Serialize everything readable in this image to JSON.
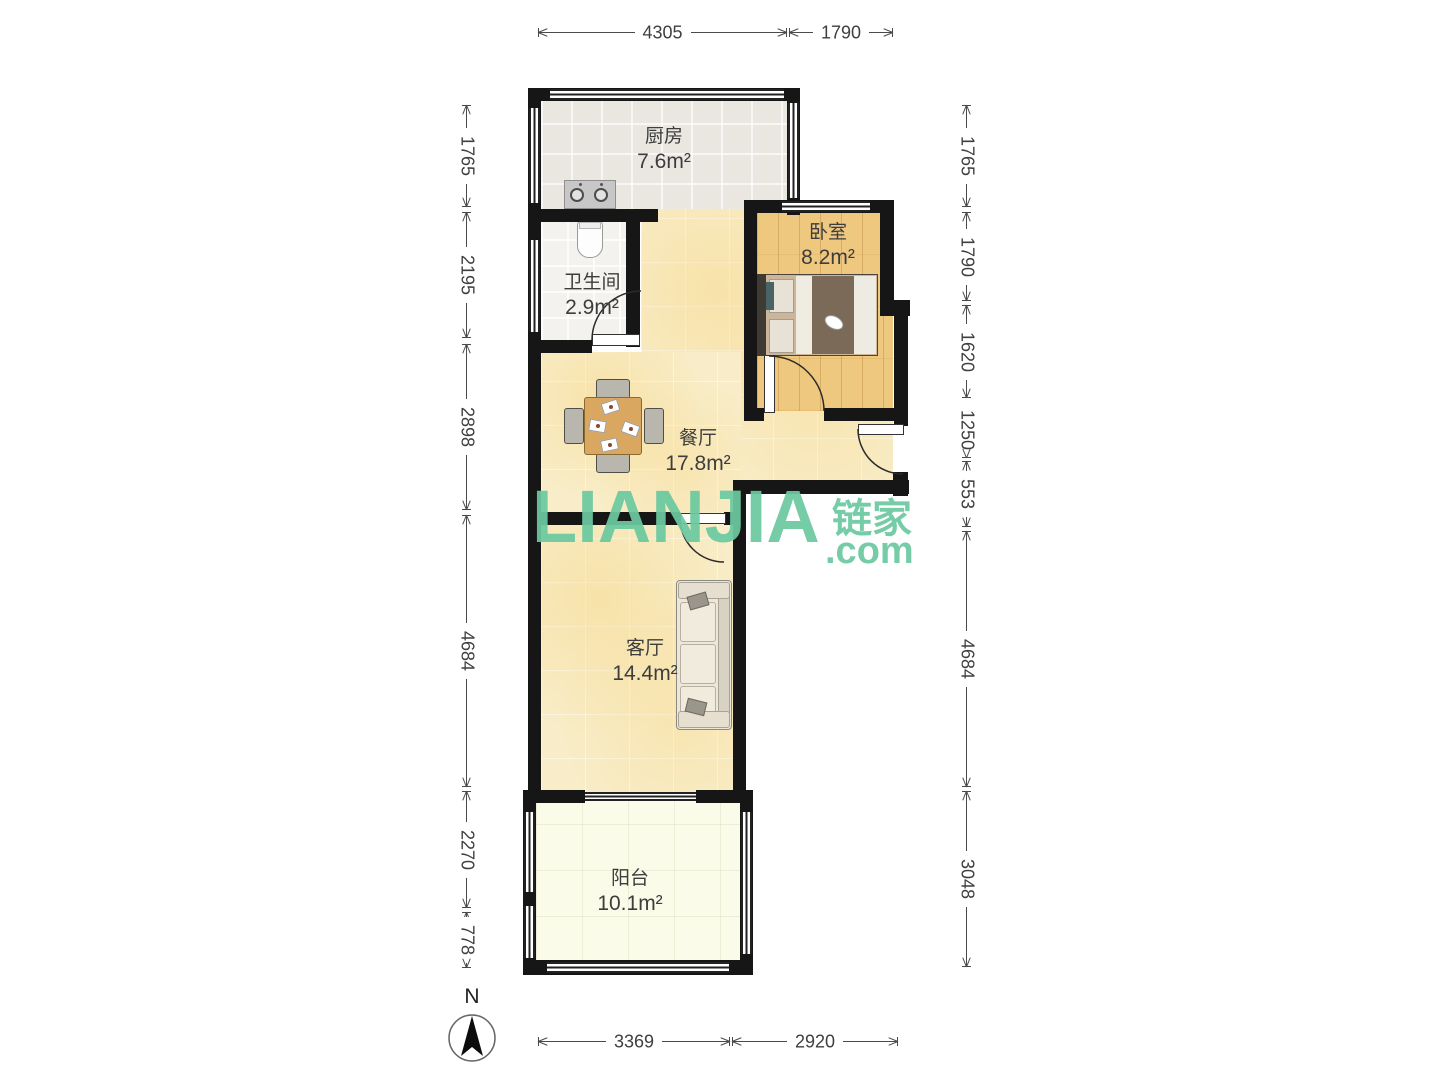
{
  "watermark": {
    "latin": "LIANJIA",
    "cjk": "链家",
    "suffix": ".com",
    "color": "#6cc9a0"
  },
  "compass": {
    "label": "N"
  },
  "rooms": {
    "kitchen": {
      "name": "厨房",
      "area": "7.6m²"
    },
    "bedroom": {
      "name": "卧室",
      "area": "8.2m²"
    },
    "bathroom": {
      "name": "卫生间",
      "area": "2.9m²"
    },
    "dining": {
      "name": "餐厅",
      "area": "17.8m²"
    },
    "living": {
      "name": "客厅",
      "area": "14.4m²"
    },
    "balcony": {
      "name": "阳台",
      "area": "10.1m²"
    }
  },
  "dimensions": {
    "top": [
      "4305",
      "1790"
    ],
    "bottom": [
      "3369",
      "2920"
    ],
    "left": [
      "1765",
      "2195",
      "2898",
      "4684",
      "2270",
      "778"
    ],
    "right": [
      "1765",
      "1790",
      "1620",
      "1250",
      "553",
      "4684",
      "3048"
    ]
  },
  "colors": {
    "wall": "#161616",
    "wood_floor": "#eec87f",
    "cream_floor": "#f8edc8",
    "kitchen_floor": "#e9e7e0",
    "balcony_floor": "#fafbe9",
    "watermark_green": "#6cc9a0"
  }
}
